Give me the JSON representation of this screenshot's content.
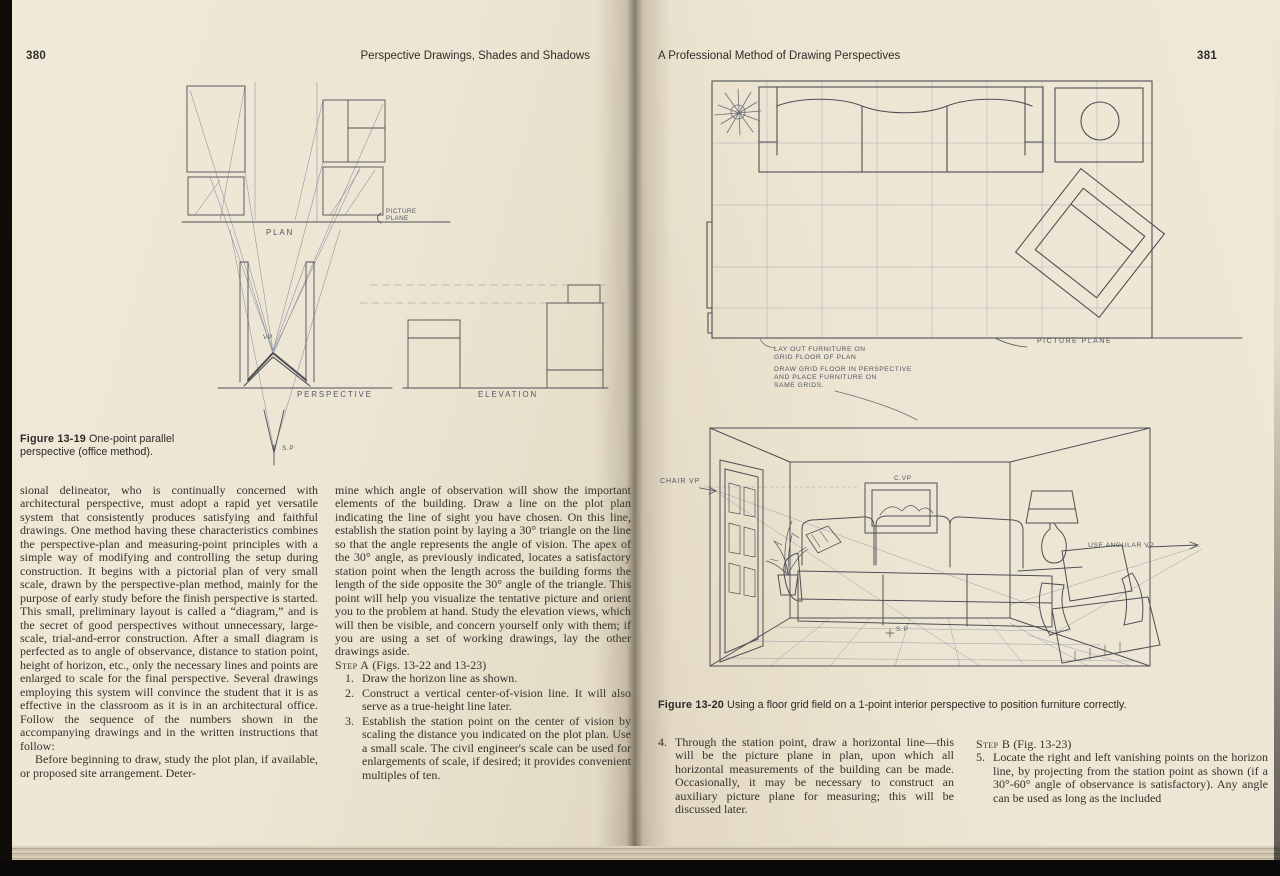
{
  "book": {
    "left_page": {
      "page_number": "380",
      "running_header": "Perspective Drawings, Shades and Shadows",
      "figure": {
        "caption_label": "Figure 13-19",
        "caption_text": "One-point parallel perspective (office method).",
        "labels": {
          "picture_plane_1": "PICTURE",
          "picture_plane_2": "PLANE",
          "plan": "PLAN",
          "vp": "VP",
          "perspective": "PERSPECTIVE",
          "elevation": "ELEVATION",
          "sp": "S.P"
        }
      },
      "col1": {
        "p1": "sional delineator, who is continually concerned with architectural perspective, must adopt a rapid yet versatile system that consistently produces satisfying and faithful drawings. One method having these characteristics combines the perspective-plan and measuring-point principles with a simple way of modifying and controlling the setup during construction. It begins with a pictorial plan of very small scale, drawn by the perspective-plan method, mainly for the purpose of early study before the finish perspective is started. This small, preliminary layout is called a “diagram,” and is the secret of good perspectives without unnecessary, large-scale, trial-and-error construction. After a small diagram is perfected as to angle of observance, distance to station point, height of horizon, etc., only the necessary lines and points are enlarged to scale for the final perspective. Several drawings employing this system will convince the student that it is as effective in the classroom as it is in an architectural office. Follow the sequence of the numbers shown in the accompanying drawings and in the written instructions that follow:",
        "p2": "Before beginning to draw, study the plot plan, if available, or proposed site arrangement. Deter-"
      },
      "col2": {
        "p1": "mine which angle of observation will show the important elements of the building. Draw a line on the plot plan indicating the line of sight you have chosen. On this line, establish the station point by laying a 30° triangle on the line so that the angle represents the angle of vision. The apex of the 30° angle, as previously indicated, locates a satisfactory station point when the length across the building forms the length of the side opposite the 30° angle of the triangle. This point will help you visualize the tentative picture and orient you to the problem at hand. Study the elevation views, which will then be visible, and concern yourself only with them; if you are using a set of working drawings, lay the other drawings aside.",
        "step_heading_sc": "Step A",
        "step_heading_rest": " (Figs. 13-22 and 13-23)",
        "list": [
          {
            "num": "1.",
            "text": "Draw the horizon line as shown."
          },
          {
            "num": "2.",
            "text": "Construct a vertical center-of-vision line. It will also serve as a true-height line later."
          },
          {
            "num": "3.",
            "text": "Establish the station point on the center of vision by scaling the distance you indicated on the plot plan. Use a small scale. The civil engineer's scale can be used for enlargements of scale, if desired; it provides convenient multiples of ten."
          }
        ]
      }
    },
    "right_page": {
      "running_header": "A Professional Method of Drawing Perspectives",
      "page_number": "381",
      "figure": {
        "caption_label": "Figure 13-20",
        "caption_text": "Using a floor grid field on a 1-point interior perspective to position furniture correctly.",
        "plan_labels": {
          "picture_plane": "PICTURE PLANE",
          "note1_1": "LAY OUT FURNITURE ON",
          "note1_2": "GRID FLOOR OF PLAN",
          "note2_1": "DRAW GRID FLOOR IN PERSPECTIVE",
          "note2_2": "AND PLACE FURNITURE ON",
          "note2_3": "SAME GRIDS."
        },
        "persp_labels": {
          "chair_vp": "CHAIR VP",
          "c_vp": "C.VP",
          "use_angular_vp": "USE ANGULAR VP",
          "sp": "S.P"
        }
      },
      "col1": {
        "item4_num": "4.",
        "item4_text": "Through the station point, draw a horizontal line—this will be the picture plane in plan, upon which all horizontal measurements of the building can be made. Occasionally, it may be necessary to construct an auxiliary picture plane for measuring; this will be discussed later."
      },
      "col2": {
        "step_heading_sc": "Step B",
        "step_heading_rest": " (Fig. 13-23)",
        "item5_num": "5.",
        "item5_text": "Locate the right and left vanishing points on the horizon line, by projecting from the station point as shown (if a 30°-60° angle of observance is satisfactory). Any angle can be used as long as the included"
      }
    }
  }
}
